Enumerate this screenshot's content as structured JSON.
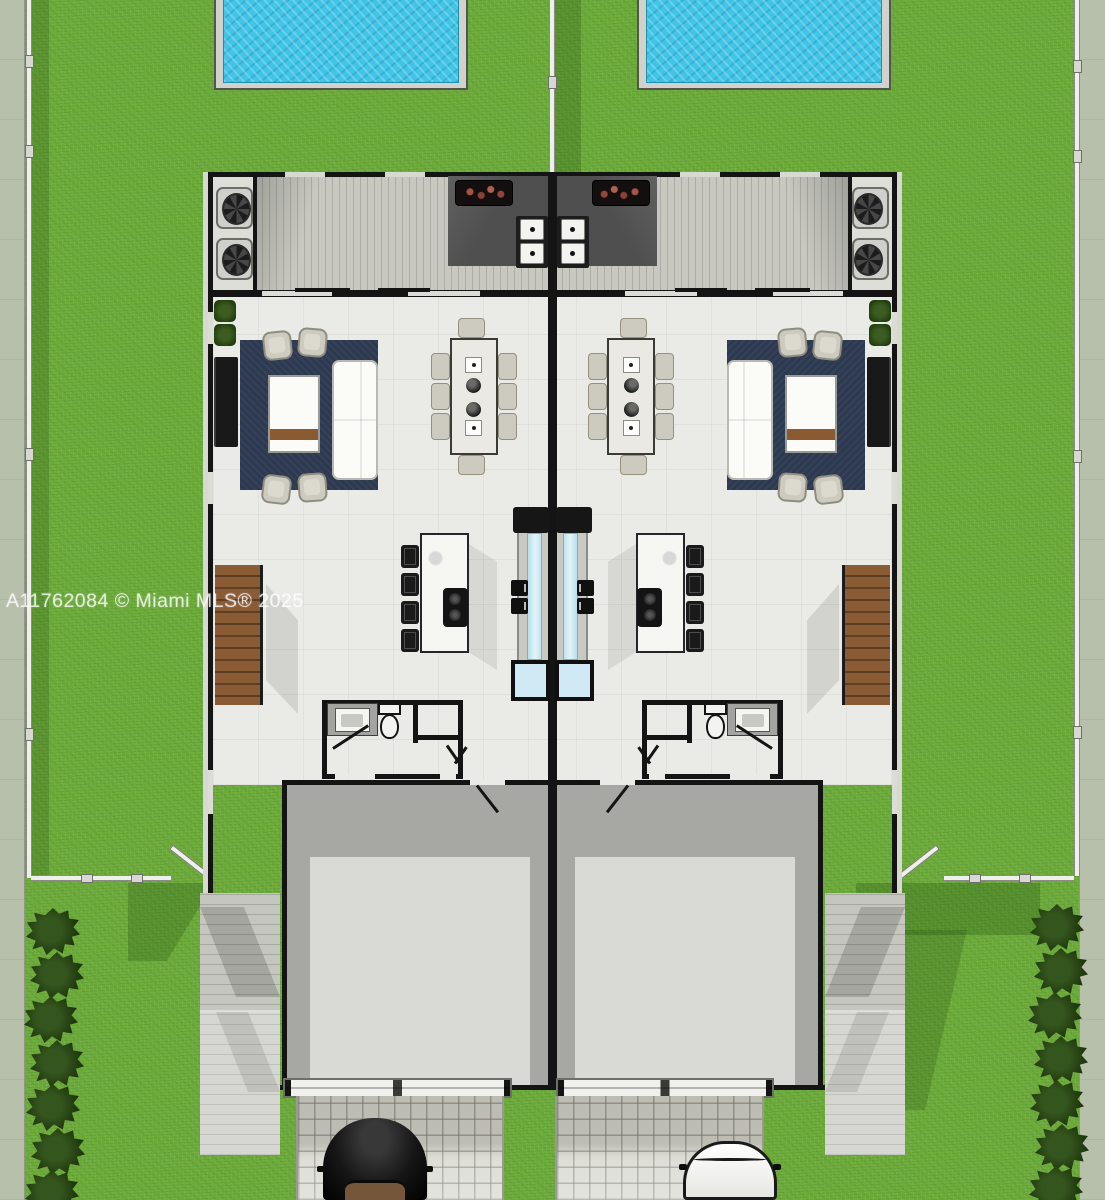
{
  "watermark": {
    "text": "A11762084 © Miami MLS® 2025"
  },
  "palette": {
    "grass": "#6fad3d",
    "sidewalk": "#b7c0aa",
    "fence_white": "#efefec",
    "pool_water": "#41c4e6",
    "pool_deck": "#d2d2cc",
    "wall_black": "#141414",
    "deck_wood": "#c8c8c1",
    "counter_dark": "#4f4f4f",
    "floor": "#eaeae7",
    "rug_navy": "#2c3950",
    "sofa_white": "#fbfbf8",
    "chair_beige": "#cdcabf",
    "stair_wood": "#8a5c36",
    "island_white": "#f6f6f3",
    "stool_black": "#1a1a1a",
    "garage_gray": "#a7a7a4",
    "garage_pad": "#d9d9d6",
    "paver": "#d7d7cf",
    "path_wood": "#c6c6c0",
    "glass_blue": "#cfeaf4",
    "car_black": "#151515",
    "car_white": "#f4f4f2"
  },
  "objects": {
    "scene": "duplex-site-plan",
    "units": [
      "unit-left",
      "unit-right"
    ],
    "per_unit": [
      "pool",
      "deck",
      "ac-unit x2",
      "bbq-grill",
      "outdoor-burners",
      "living-rug",
      "sofa",
      "coffee-table",
      "armchair x4",
      "dining-table",
      "dining-chair x8",
      "kitchen-island",
      "bar-stool x4",
      "staircase",
      "vanity-sink",
      "toilet",
      "closet",
      "garage",
      "garage-door",
      "side-path"
    ],
    "site": [
      "left-sidewalk",
      "right-sidewalk",
      "property-fences",
      "gates",
      "hedge-rows",
      "driveway-pavers x2",
      "car-black",
      "car-white"
    ]
  }
}
